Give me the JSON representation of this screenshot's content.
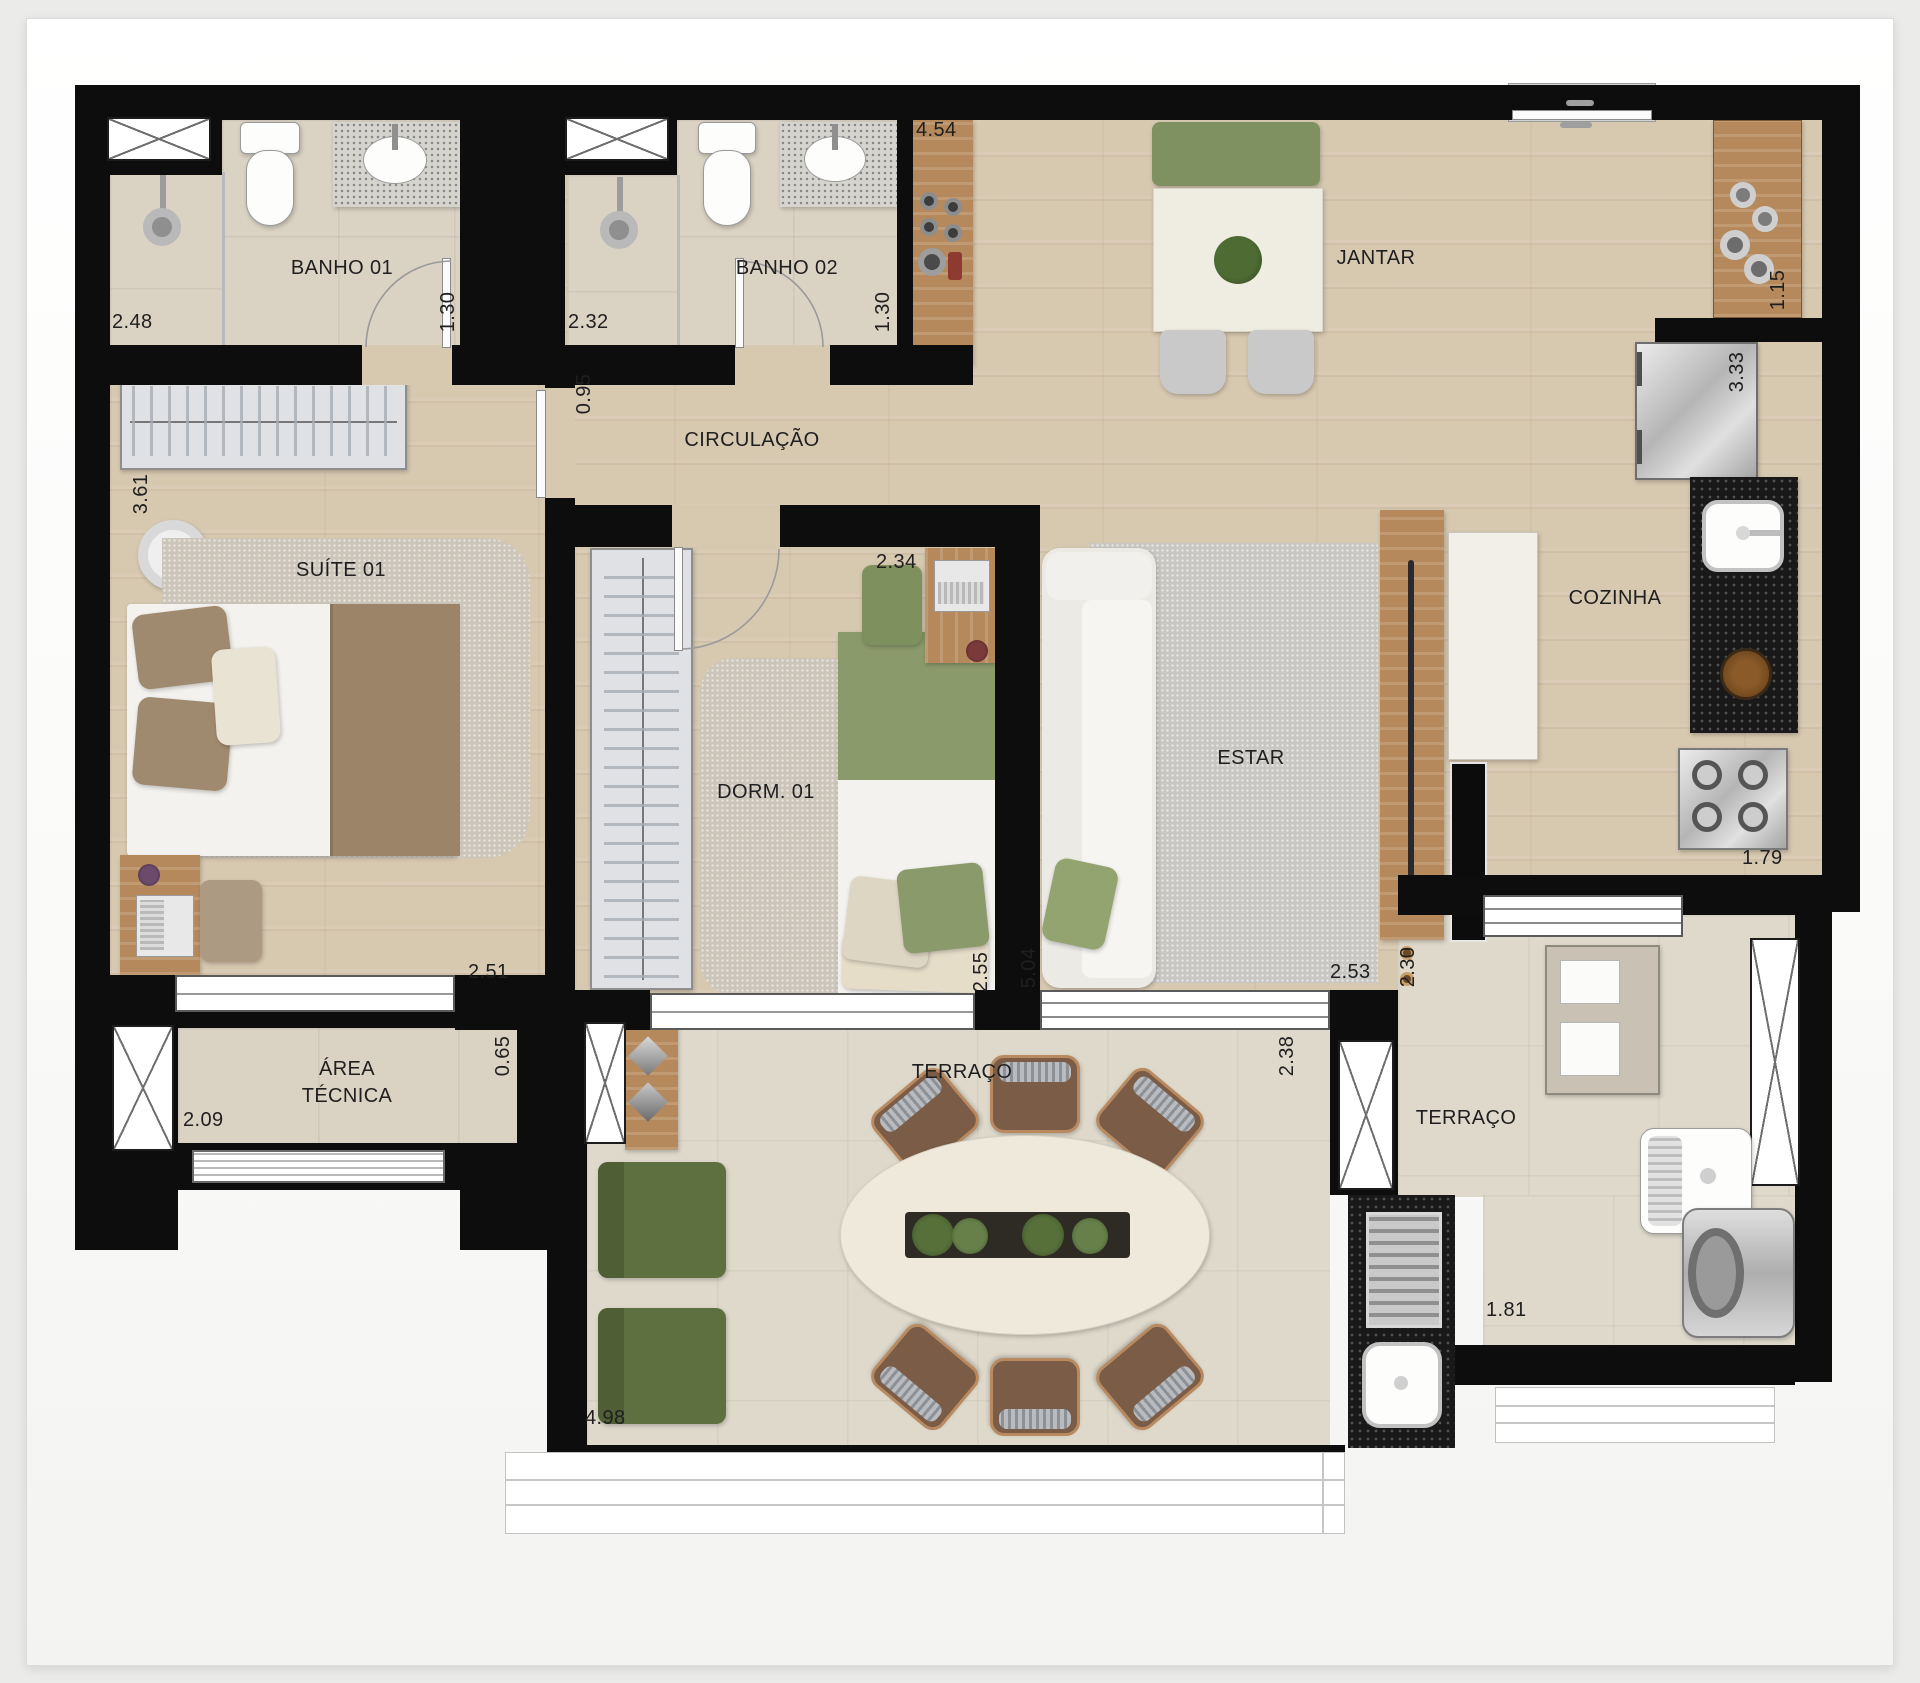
{
  "palette": {
    "wall": "#0d0d0d",
    "wood_floor": "#d7c8b0",
    "bath_tile": "#dad2c3",
    "terrace_tile": "#ded9cb",
    "furniture_wood": "#b5895c",
    "granite_dark": "#191919",
    "green_upholstery": "#74844e",
    "olive_armchair": "#5f7040",
    "brown_chair": "#7b5c46",
    "label_text": "#1f1f1f"
  },
  "rooms": [
    {
      "id": "banho-01",
      "label": "BANHO 01",
      "dims": [
        "2.48",
        "1.30"
      ]
    },
    {
      "id": "banho-02",
      "label": "BANHO 02",
      "dims": [
        "2.32",
        "1.30"
      ]
    },
    {
      "id": "jantar",
      "label": "JANTAR",
      "dims": [
        "4.54",
        "1.15"
      ]
    },
    {
      "id": "circulacao",
      "label": "CIRCULAÇÃO",
      "dims": [
        "0.95"
      ]
    },
    {
      "id": "suite-01",
      "label": "SUÍTE 01",
      "dims": [
        "3.61",
        "2.51"
      ]
    },
    {
      "id": "dorm-01",
      "label": "DORM. 01",
      "dims": [
        "2.34",
        "2.55"
      ]
    },
    {
      "id": "estar",
      "label": "ESTAR",
      "dims": [
        "5.04",
        "2.53"
      ]
    },
    {
      "id": "cozinha",
      "label": "COZINHA",
      "dims": [
        "3.33",
        "1.79"
      ]
    },
    {
      "id": "area-tecnica",
      "label": "ÁREA TÉCNICA",
      "dims": [
        "2.09",
        "0.65"
      ]
    },
    {
      "id": "terraco",
      "label": "TERRAÇO",
      "dims": [
        "2.38",
        "4.98"
      ]
    },
    {
      "id": "terraco-servico",
      "label": "TERRAÇO",
      "dims": [
        "2.30",
        "1.81"
      ]
    }
  ]
}
